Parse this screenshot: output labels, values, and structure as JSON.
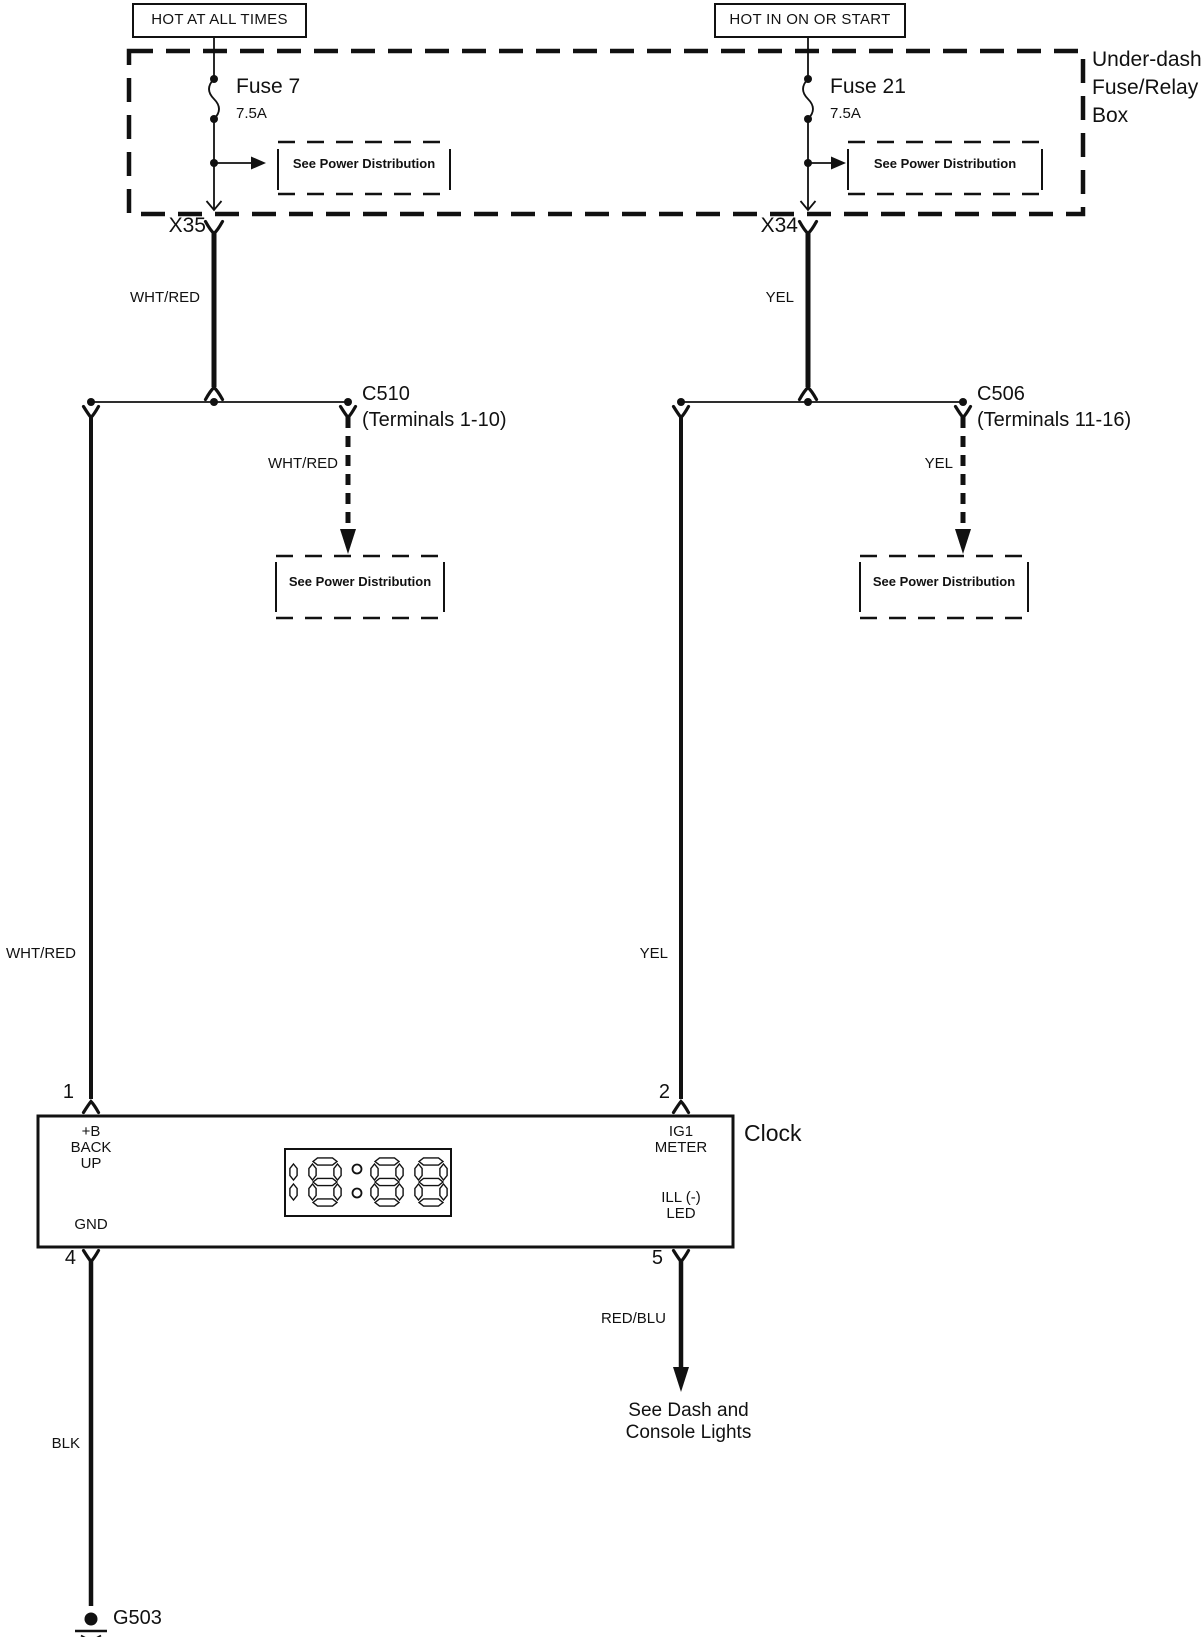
{
  "titles": {
    "left": "HOT AT ALL TIMES",
    "right": "HOT IN ON OR START"
  },
  "fuse_box": {
    "label": "Under-dash\nFuse/Relay\nBox"
  },
  "fuses": {
    "left": {
      "name": "Fuse 7",
      "rating": "7.5A"
    },
    "right": {
      "name": "Fuse 21",
      "rating": "7.5A"
    }
  },
  "refs": {
    "power": "See Power Distribution",
    "dash_console": "See Dash and\nConsole Lights"
  },
  "connectors": {
    "x35": "X35",
    "x34": "X34",
    "c510": "C510\n(Terminals 1-10)",
    "c506": "C506\n(Terminals 11-16)"
  },
  "wires": {
    "wht_red": "WHT/RED",
    "yel": "YEL",
    "red_blu": "RED/BLU",
    "blk": "BLK"
  },
  "clock": {
    "label": "Clock",
    "display": "18:88",
    "terminals": {
      "t1": {
        "num": "1",
        "label": "+B\nBACK\nUP"
      },
      "t2": {
        "num": "2",
        "label": "IG1\nMETER"
      },
      "t4": {
        "num": "4",
        "label": "GND"
      },
      "t5": {
        "num": "5",
        "label": "ILL (-)\nLED"
      }
    }
  },
  "ground": {
    "label": "G503"
  }
}
